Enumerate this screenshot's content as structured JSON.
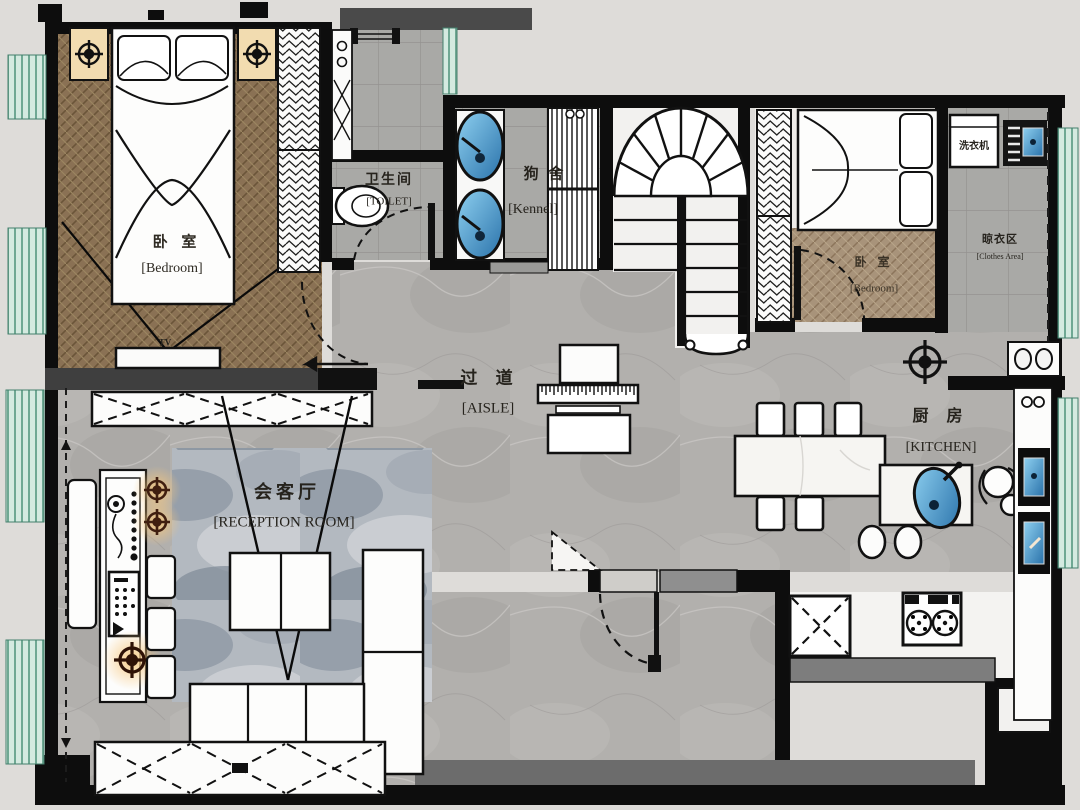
{
  "plan": {
    "type": "residential-floor-plan",
    "rooms": {
      "bedroom_left": {
        "name_zh": "卧 室",
        "name_en": "[Bedroom]"
      },
      "toilet": {
        "name_zh": "卫生间",
        "name_en": "[TOILET]"
      },
      "kennel": {
        "name_zh": "狗 舍",
        "name_en": "[Kennel]"
      },
      "bedroom_right": {
        "name_zh": "卧 室",
        "name_en": "[Bedroom]"
      },
      "clothes_area": {
        "name_zh": "晾衣区",
        "name_en": "[Clothes Area]"
      },
      "aisle": {
        "name_zh": "过 道",
        "name_en": "[AISLE]"
      },
      "reception": {
        "name_zh": "会客厅",
        "name_en": "[RECEPTION ROOM]"
      },
      "kitchen": {
        "name_zh": "厨 房",
        "name_en": "[KITCHEN]"
      }
    },
    "appliances": {
      "washing_machine": "洗衣机",
      "tv": "TV"
    },
    "colors": {
      "wall": "#0d0d0d",
      "fixture_blue": "#4d9fd8",
      "window_glass": "#d4eae0",
      "wood_floor": "#8a7154",
      "lamp_warm": "#f2dcb0"
    }
  }
}
